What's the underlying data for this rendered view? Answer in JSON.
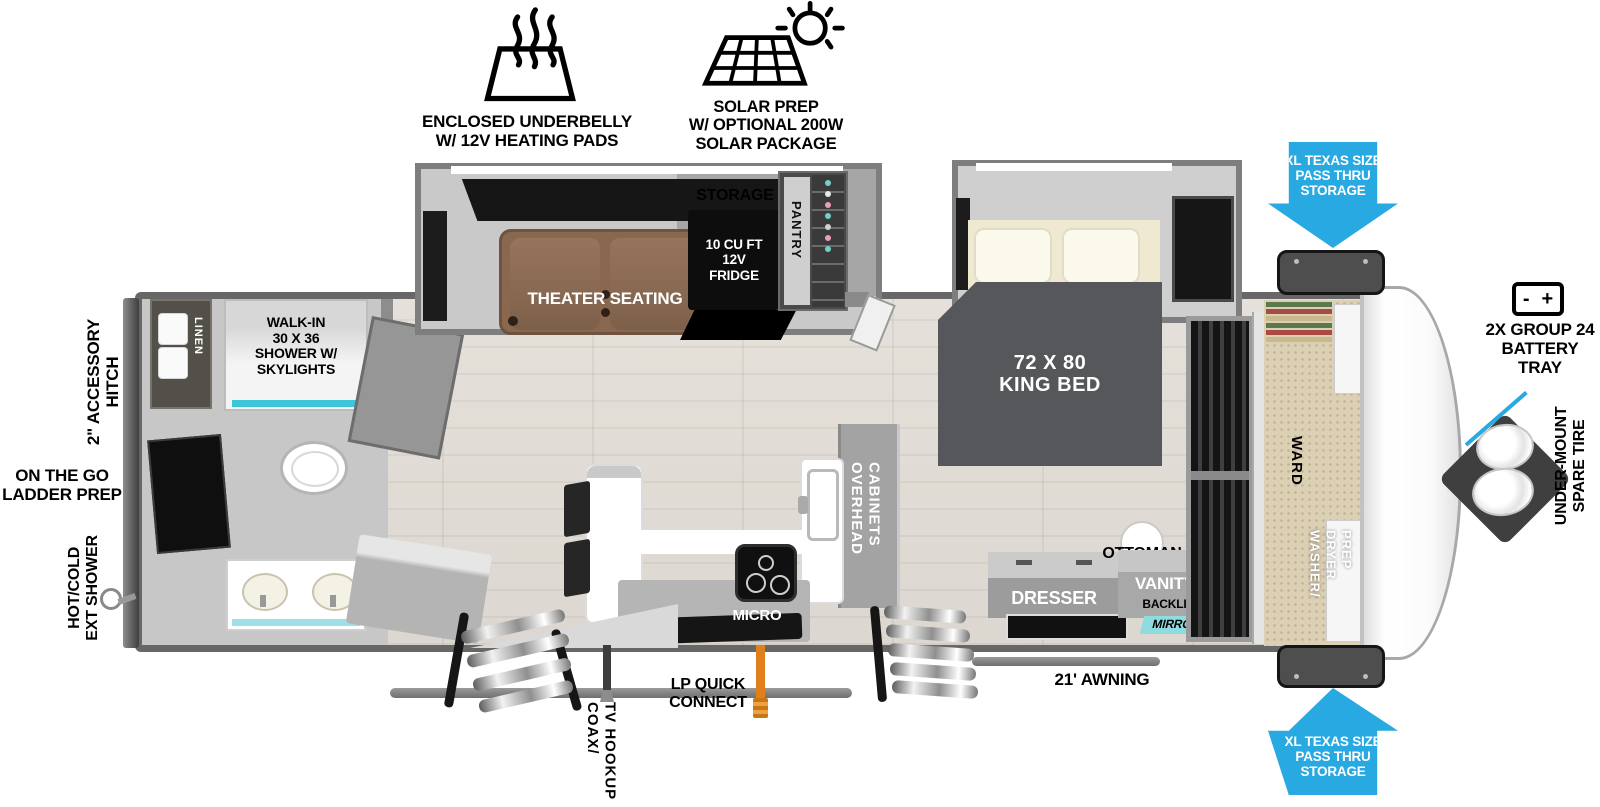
{
  "features": {
    "underbelly": "ENCLOSED UNDERBELLY\nW/ 12V HEATING PADS",
    "solar": "SOLAR PREP\nW/ OPTIONAL 200W\nSOLAR PACKAGE"
  },
  "exterior": {
    "passthru_top": "XL TEXAS SIZE\nPASS THRU\nSTORAGE",
    "passthru_bottom": "XL TEXAS SIZE\nPASS THRU\nSTORAGE",
    "battery_label": "2X GROUP 24\nBATTERY\nTRAY",
    "battery_minus": "-",
    "battery_plus": "+",
    "spare_tire": "UNDER-MOUNT\nSPARE TIRE",
    "accessory_hitch": "2\" ACCESSORY\nHITCH",
    "ladder_prep": "ON THE GO\nLADDER PREP",
    "ext_shower": "HOT/COLD\nEXT SHOWER",
    "awning": "21' AWNING",
    "lp_quick_connect": "LP QUICK\nCONNECT",
    "coax": [
      "COAX/",
      "TV HOOKUP"
    ]
  },
  "bathroom": {
    "linen": "LINEN",
    "shower": "WALK-IN\n30 X 36\nSHOWER W/\nSKYLIGHTS"
  },
  "living": {
    "panoramic_window": "PANORAMIC WINDOW",
    "theater_seating": "THEATER SEATING",
    "storage": "STORAGE",
    "fridge": "10 CU FT\n12V\nFRIDGE",
    "pantry": "PANTRY"
  },
  "kitchen": {
    "overhead_cabinets": [
      "OVERHEAD",
      "CABINETS"
    ],
    "micro": "MICRO"
  },
  "bedroom": {
    "king_bed": "72 X  80\nKING BED",
    "ottoman": "OTTOMAN",
    "dresser": "DRESSER",
    "vanity": "VANITY",
    "backlit": "BACKLIT",
    "mirror": "MIRROR"
  },
  "front": {
    "ward": "WARD",
    "washer_dryer": [
      "WASHER/",
      "DRYER",
      "PREP"
    ]
  },
  "colors": {
    "arrow_blue": "#29a9e1",
    "teal": "#3cc6d8",
    "mirror_teal": "#8edce0",
    "lp_orange": "#e0801c"
  }
}
